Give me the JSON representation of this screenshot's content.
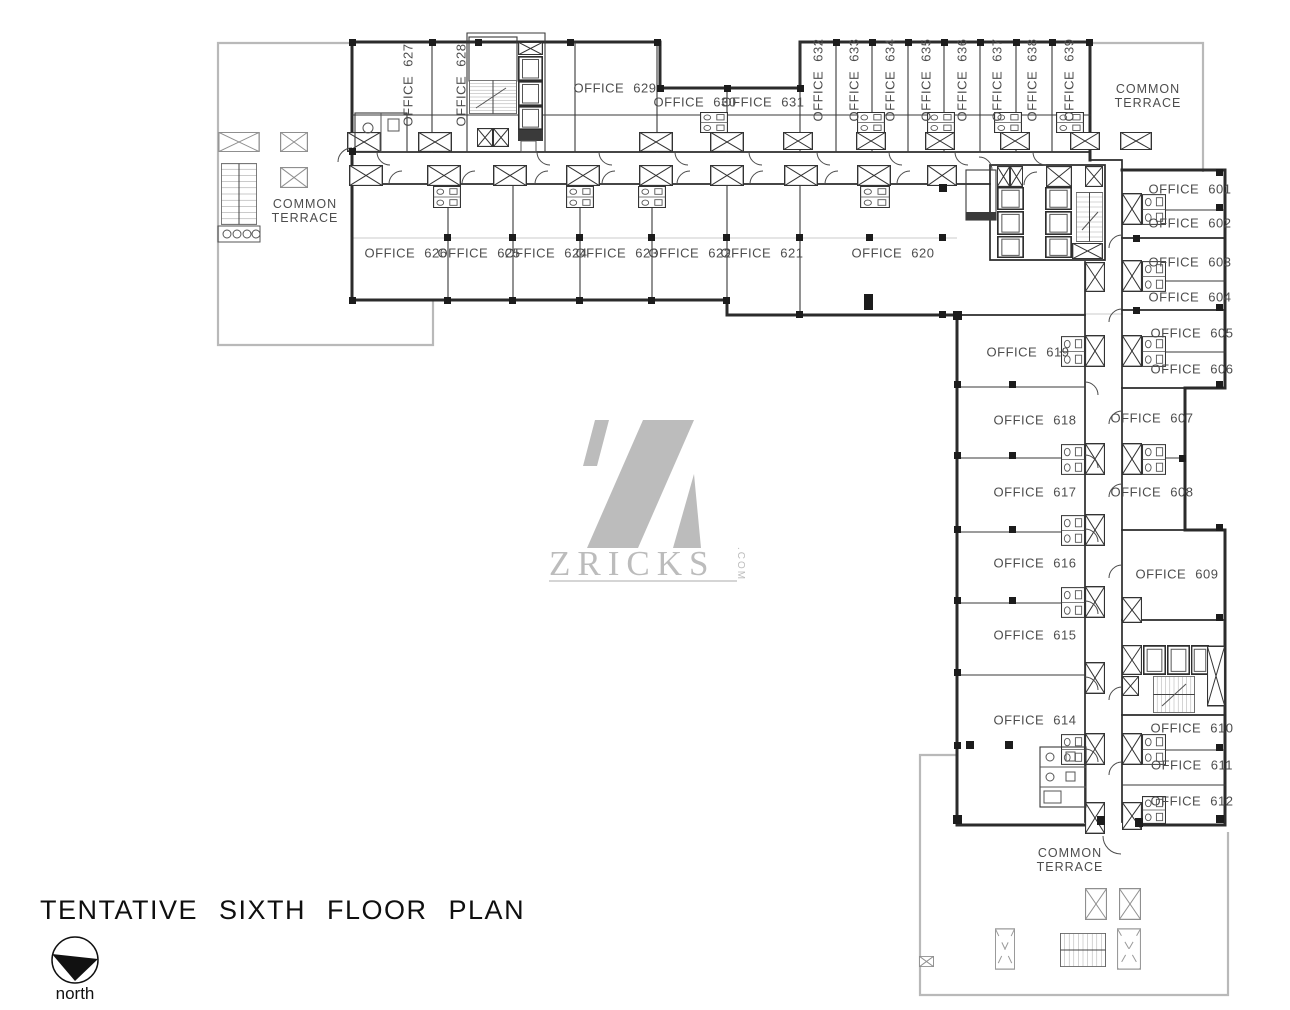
{
  "title": "TENTATIVE SIXTH FLOOR PLAN",
  "north_label": "north",
  "watermark": {
    "brand": "ZRICKS",
    "tld": ".COM"
  },
  "terraces": {
    "left": {
      "line1": "COMMON",
      "line2": "TERRACE"
    },
    "top_right": {
      "line1": "COMMON",
      "line2": "TERRACE"
    },
    "bottom": {
      "line1": "COMMON",
      "line2": "TERRACE"
    }
  },
  "colors": {
    "wall": "#2b2b2b",
    "light_line": "#b9b9b9",
    "label": "#4d4d4d",
    "watermark": "#b5b5b5"
  },
  "offices": {
    "601": "OFFICE 601",
    "602": "OFFICE 602",
    "603": "OFFICE 603",
    "604": "OFFICE 604",
    "605": "OFFICE 605",
    "606": "OFFICE 606",
    "607": "OFFICE 607",
    "608": "OFFICE 608",
    "609": "OFFICE 609",
    "610": "OFFICE 610",
    "611": "OFFICE 611",
    "612": "OFFICE 612",
    "614": "OFFICE 614",
    "615": "OFFICE 615",
    "616": "OFFICE 616",
    "617": "OFFICE 617",
    "618": "OFFICE 618",
    "619": "OFFICE 619",
    "620": "OFFICE 620",
    "621": "OFFICE 621",
    "622": "OFFICE 622",
    "623": "OFFICE 623",
    "624": "OFFICE 624",
    "625": "OFFICE 625",
    "626": "OFFICE 626",
    "627": "OFFICE 627",
    "628": "OFFICE 628",
    "629": "OFFICE 629",
    "630": "OFFICE 630",
    "631": "OFFICE 631",
    "632": "OFFICE 632",
    "633": "OFFICE 633",
    "634": "OFFICE 634",
    "635": "OFFICE 635",
    "636": "OFFICE 636",
    "637": "OFFICE 637",
    "638": "OFFICE 638",
    "639": "OFFICE 639"
  }
}
